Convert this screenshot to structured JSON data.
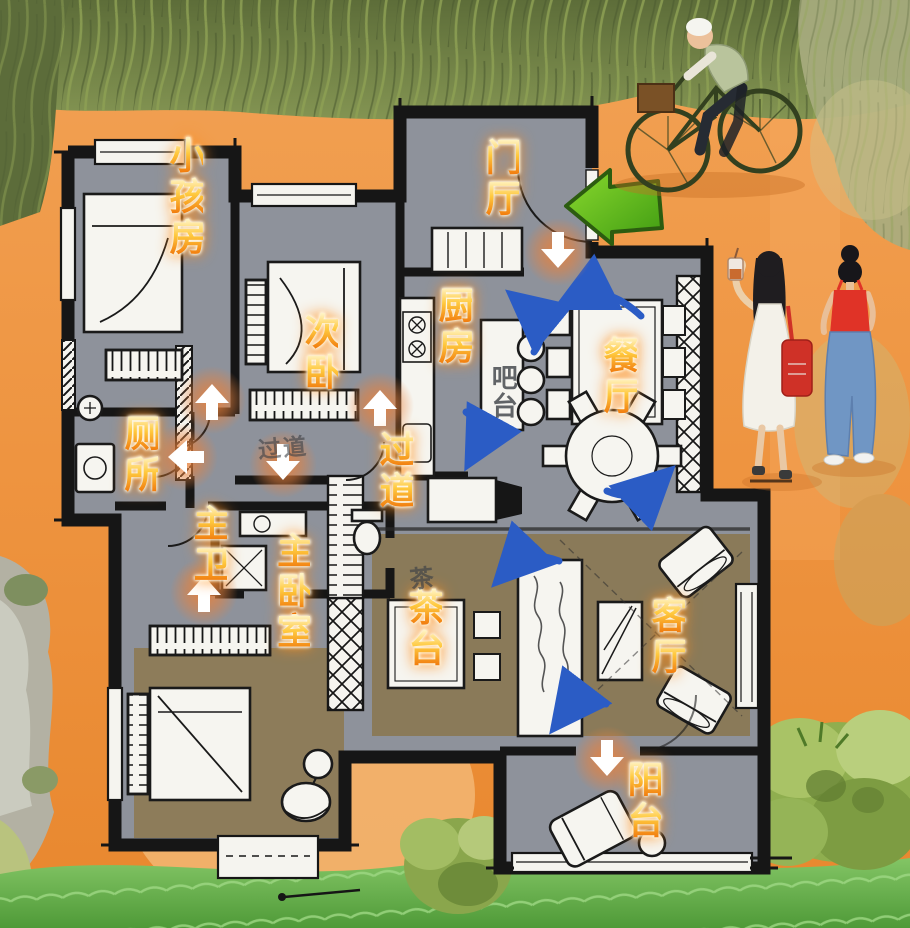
{
  "illustration": {
    "kind": "hand-drawn apartment floor plan over painted park scene",
    "figures": [
      "elderly-cyclist",
      "two-women-walking"
    ]
  },
  "rooms": [
    {
      "id": "kids-room",
      "label": "小孩房"
    },
    {
      "id": "second-bedroom",
      "label": "次卧"
    },
    {
      "id": "entry-hall",
      "label": "门厅"
    },
    {
      "id": "kitchen",
      "label": "厨房"
    },
    {
      "id": "dining-room",
      "label": "餐厅"
    },
    {
      "id": "toilet",
      "label": "厕所"
    },
    {
      "id": "hallway",
      "label": "过道"
    },
    {
      "id": "master-bath",
      "label": "主卫"
    },
    {
      "id": "master-bedroom",
      "label": "主卧室"
    },
    {
      "id": "tea-area",
      "label": "茶台"
    },
    {
      "id": "living-room",
      "label": "客厅"
    },
    {
      "id": "balcony",
      "label": "阳台"
    }
  ],
  "notes": {
    "bar_counter": "吧台",
    "tea_table": "茶",
    "hallway_sketch": "过道"
  },
  "flow": {
    "entry_arrow_direction": "left",
    "glow_arrow_directions": [
      "down",
      "up",
      "up",
      "left",
      "down",
      "up",
      "down"
    ],
    "swirl_arrow_count": 6
  },
  "colors": {
    "path_orange": "#ee9440",
    "floor_gray": "#8e929b",
    "rug_brown": "#8a7a59",
    "wall_black": "#161616",
    "label_orange": "#f0760a",
    "arrow_blue": "#2b5cc5",
    "entry_arrow_green": "#58b822",
    "grass_top": "#61713c",
    "grass_bottom": "#57a33b"
  }
}
